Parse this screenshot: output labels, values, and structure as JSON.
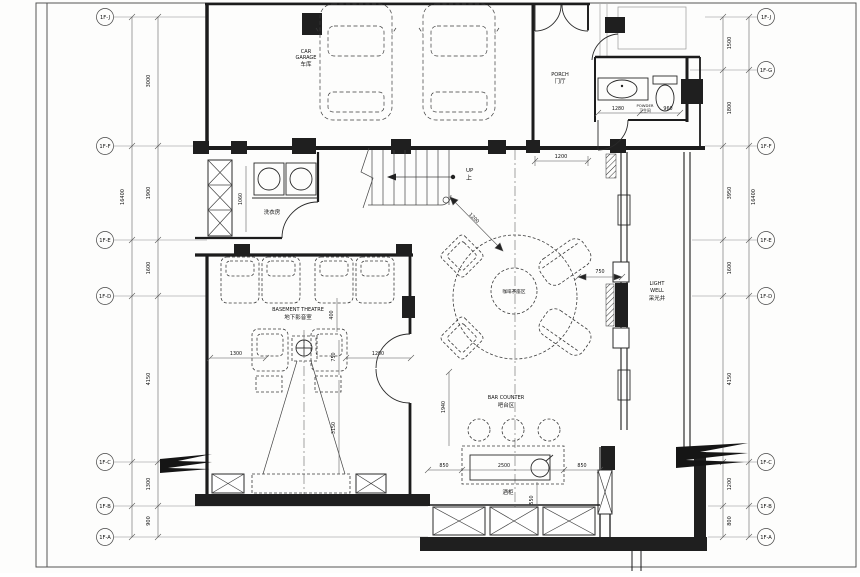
{
  "drawing": {
    "grid": {
      "left": [
        {
          "label": "1F-J"
        },
        {
          "label": "1F-F"
        },
        {
          "label": "1F-E"
        },
        {
          "label": "1F-D"
        },
        {
          "label": "1F-C"
        },
        {
          "label": "1F-B"
        },
        {
          "label": "1F-A"
        }
      ],
      "right": [
        {
          "label": "1F-J"
        },
        {
          "label": "1F-G"
        },
        {
          "label": "1F-F"
        },
        {
          "label": "1F-E"
        },
        {
          "label": "1F-D"
        },
        {
          "label": "1F-C"
        },
        {
          "label": "1F-B"
        },
        {
          "label": "1F-A"
        }
      ],
      "left_dims": [
        "3000",
        "1900",
        "1600",
        "4150",
        "1300",
        "900"
      ],
      "right_dims": [
        "1500",
        "1800",
        "3950",
        "1600",
        "4150",
        "1200",
        "800"
      ],
      "overall_left": "16400",
      "overall_right": "16400"
    },
    "rooms": {
      "garage_l1": "CAR",
      "garage_l2": "GARAGE",
      "garage_l3": "车库",
      "porch_l1": "PORCH",
      "porch_l2": "门厅",
      "powder_l1": "POWDER",
      "powder_l2": "卫生间",
      "laundry": "洗衣房",
      "theatre_l1": "BASEMENT THEATRE",
      "theatre_l2": "地下影音室",
      "coffee": "咖啡茶座区",
      "lightwell_l1": "LIGHT",
      "lightwell_l2": "WELL",
      "lightwell_l3": "采光井",
      "bar_l1": "BAR COUNTER",
      "bar_l2": "吧台区",
      "wine": "酒柜",
      "up_l1": "UP",
      "up_l2": "上"
    },
    "dims": {
      "porch_below": "1200",
      "stair_diag": "1200",
      "powder_a": "1280",
      "powder_b": "960",
      "laundry_w": "1060",
      "theatre_gap": "400",
      "theatre_left": "1300",
      "theatre_mid": "750",
      "theatre_right": "1200",
      "theatre_depth": "3150",
      "table_right": "750",
      "bar_h": "1940",
      "bar_left": "850",
      "bar_center": "2500",
      "bar_right": "850",
      "wine_d": "550"
    }
  }
}
